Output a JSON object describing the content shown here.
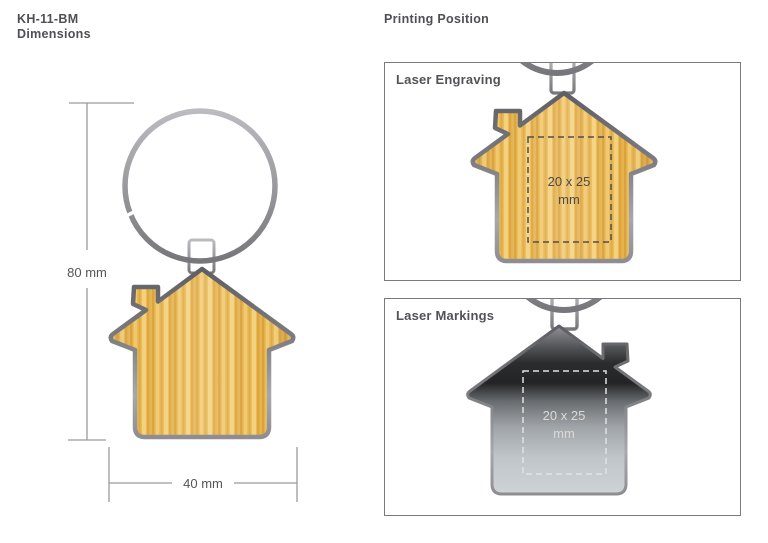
{
  "header": {
    "product_code": "KH-11-BM",
    "left_subtitle": "Dimensions",
    "right_title": "Printing Position"
  },
  "dimension_drawing": {
    "height_label": "80 mm",
    "width_label": "40 mm"
  },
  "panels": [
    {
      "label": "Laser Engraving",
      "area_line1": "20 x 25",
      "area_line2": "mm"
    },
    {
      "label": "Laser Markings",
      "area_line1": "20 x 25",
      "area_line2": "mm"
    }
  ],
  "illustrations": {
    "left": "keyring-with-house-keychain-front",
    "panel_1": "house-keychain-bamboo-front",
    "panel_2": "house-keychain-metal-back"
  },
  "colors": {
    "background": "#ffffff",
    "text": "#4f4f54",
    "panel_border": "#7a7a7a",
    "dimension_line": "#9b9b9b",
    "bamboo": "#eaba55",
    "metal_rim_light": "#b9b9bd",
    "metal_rim_dark": "#606066",
    "steel_dark": "#2b2c2e",
    "steel_light": "#ced3d7",
    "print_area_dash_dark": "#4f4f4f",
    "print_area_dash_light": "#e2e2e2"
  }
}
